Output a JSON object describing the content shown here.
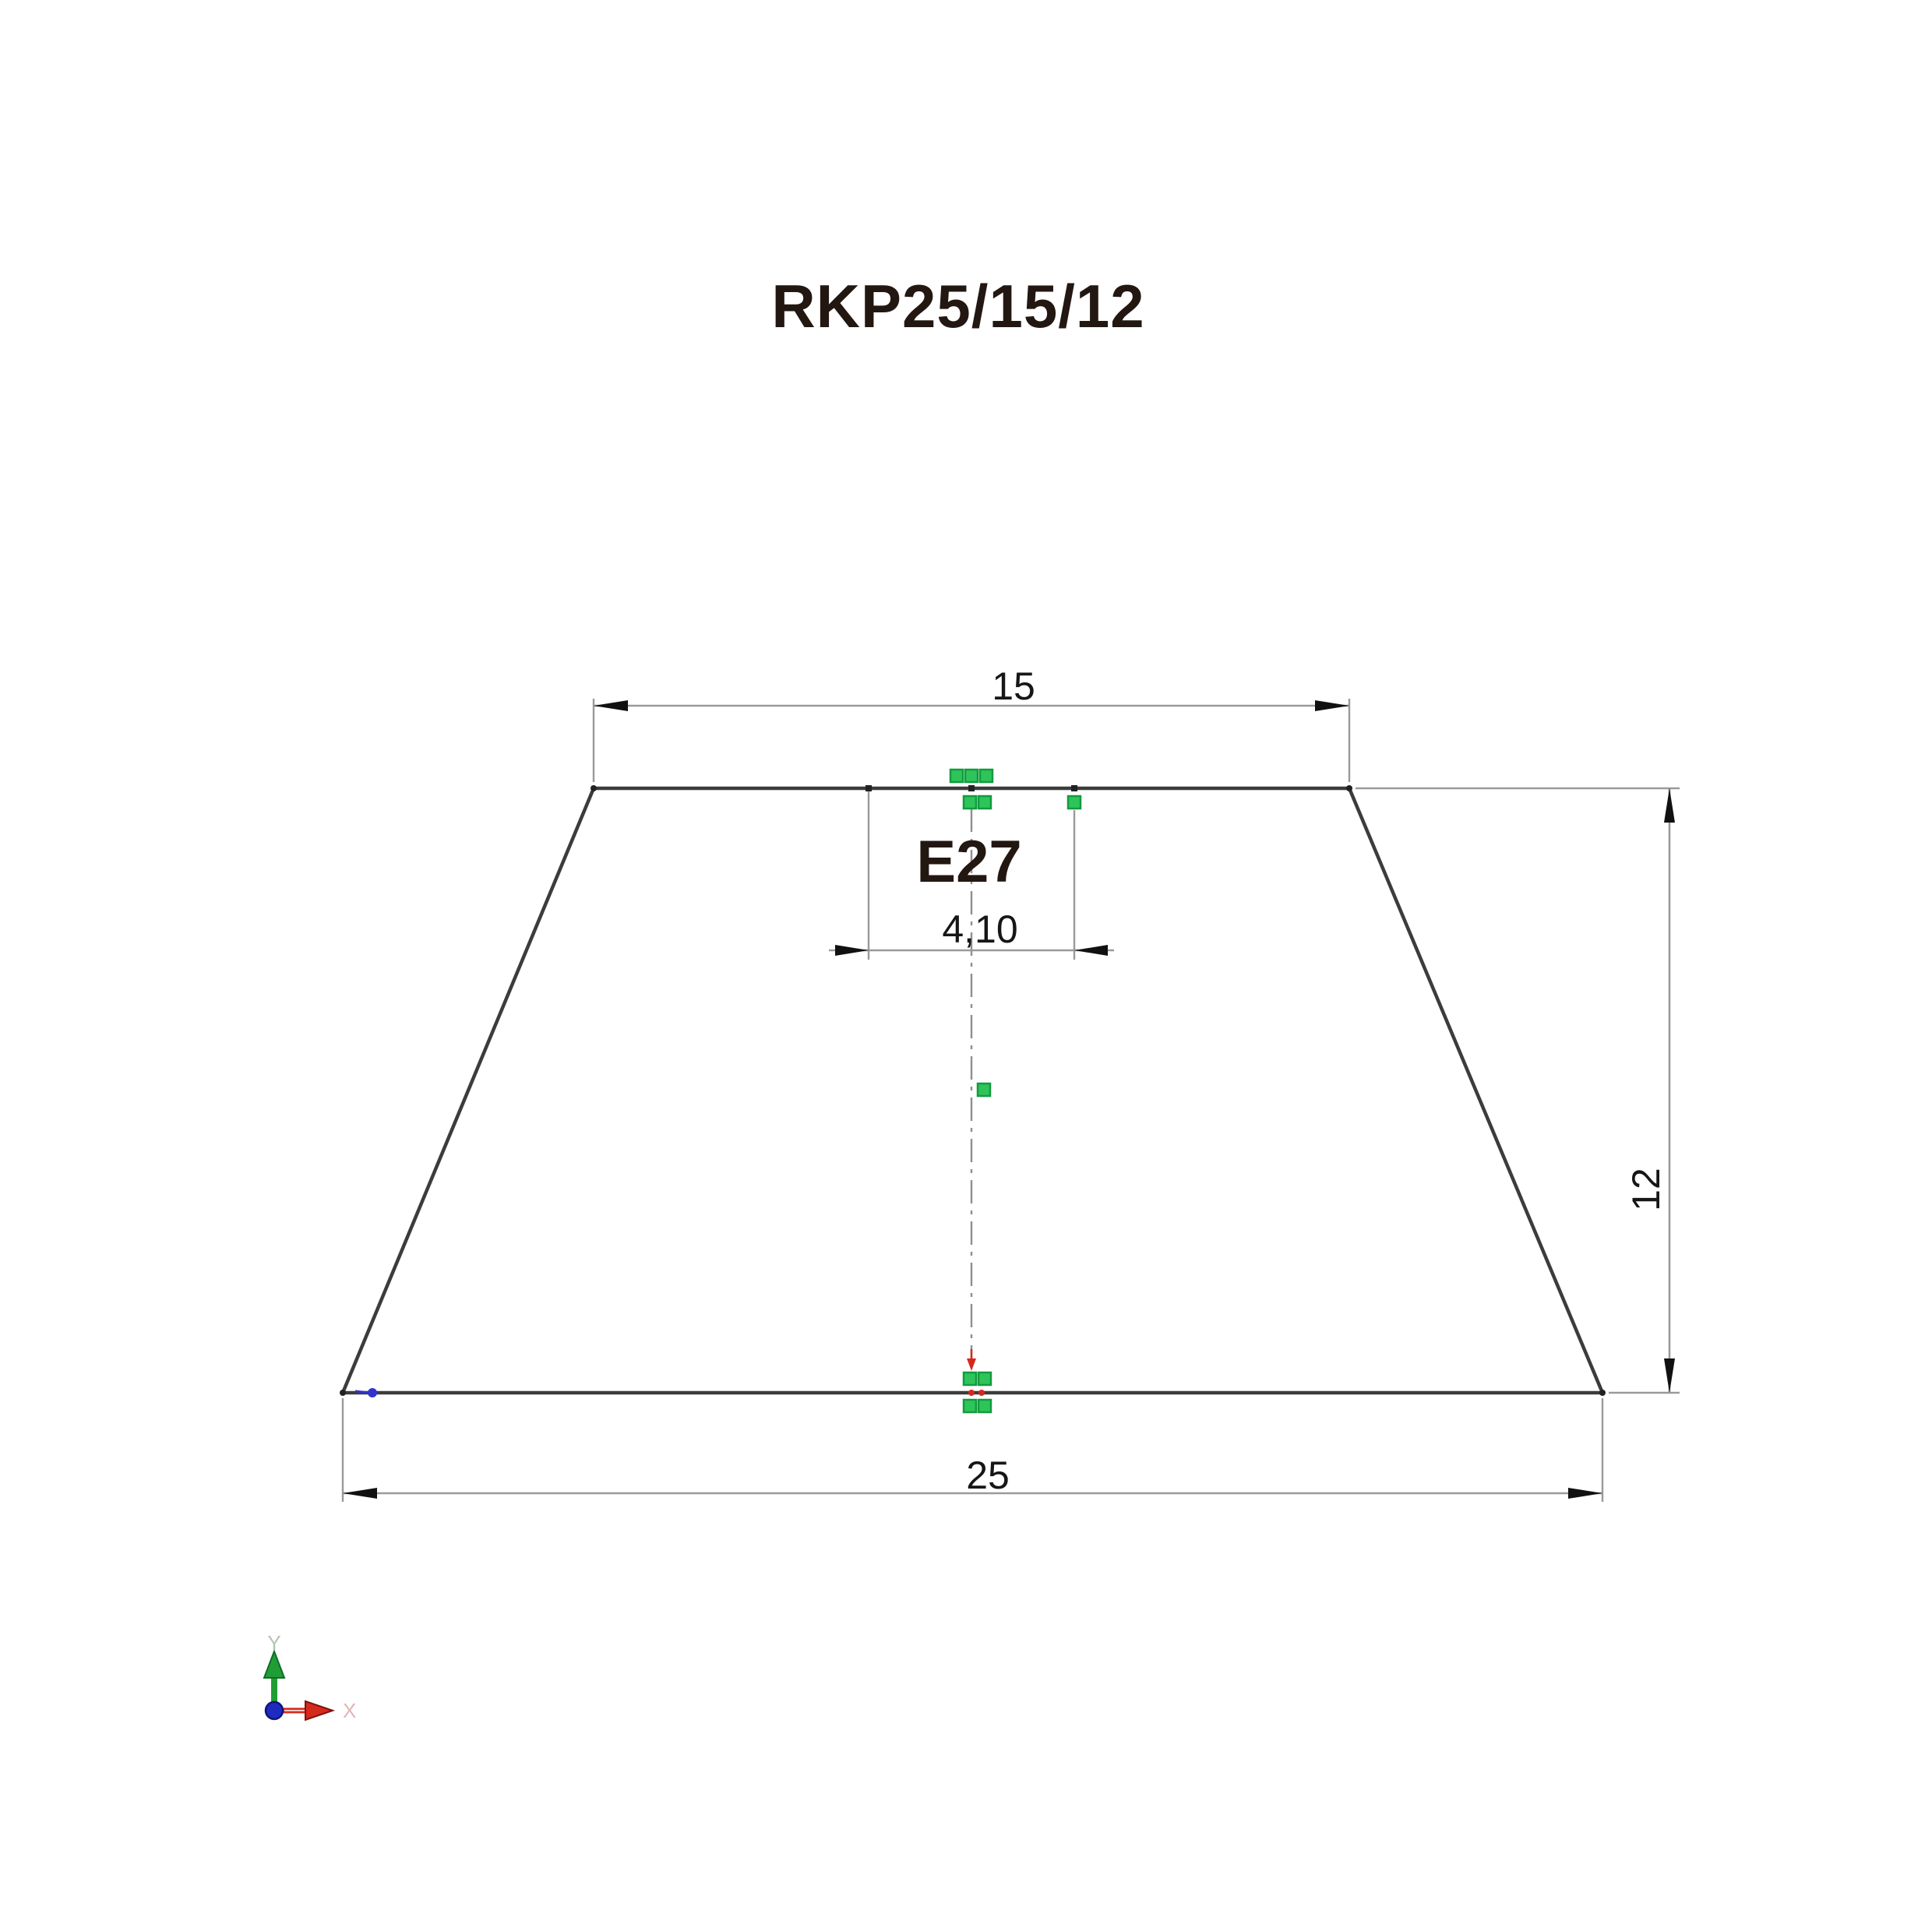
{
  "title": "RKP25/15/12",
  "drawing": {
    "socket_label": "E27",
    "dimensions": {
      "top_width": {
        "label": "15"
      },
      "bottom_width": {
        "label": "25"
      },
      "height": {
        "label": "12"
      },
      "socket_hole": {
        "label": "4,10"
      }
    },
    "axis": {
      "y_label": "Y",
      "x_label": "X"
    }
  },
  "colors": {
    "outline": "#3c3c3c",
    "dimension_line": "#9a9a9a",
    "dimension_text": "#161616",
    "arrow_black": "#111111",
    "title_text": "#231712",
    "grip_green": "#2ec45a",
    "grip_green_border": "#129b3f",
    "centerline": "#8f8f8f",
    "node_black": "#222222",
    "marker_red": "#d8281c",
    "vertex_blue": "#3232cd",
    "axis_green": "#1f9e35",
    "axis_green_dark": "#0d6e24",
    "axis_red": "#d42a1c",
    "axis_red_dark": "#7e120b",
    "axis_origin_blue": "#1f2bbf",
    "axis_origin_dark": "#10157a",
    "axis_label_green": "#b0c6ae",
    "axis_label_red": "#e2b4b8"
  }
}
